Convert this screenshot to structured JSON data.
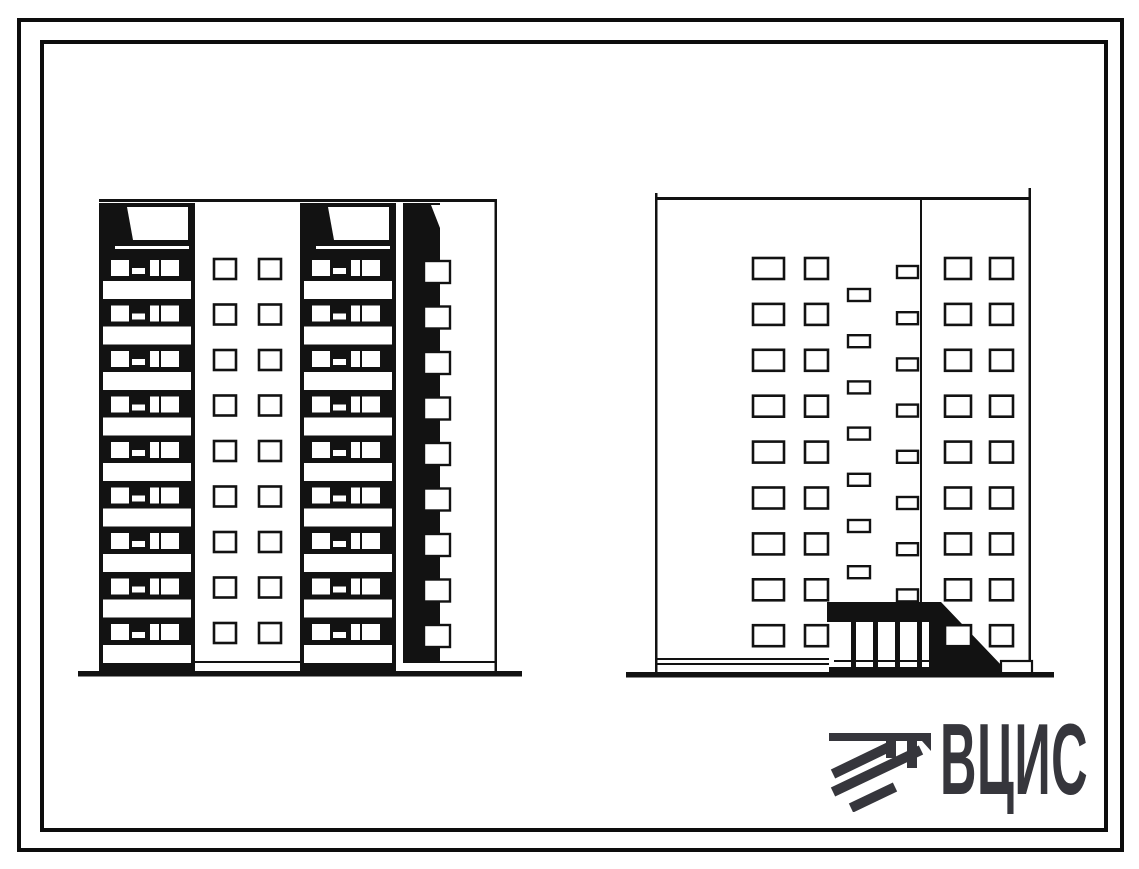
{
  "sheet": {
    "background": "#ffffff",
    "border_color": "#0d0d0d",
    "description": "Scanned architectural sheet with two elevations of a 9-storey large-panel residential block"
  },
  "logo": {
    "text": "ВЦИС",
    "color": "#36363c",
    "mark": "diagonal-hatching-emblem"
  },
  "drawing": {
    "ink": "#121212",
    "paper": "#ffffff",
    "left_elevation": {
      "label": "courtyard elevation with balcony stacks",
      "floors": 9,
      "row_start": 258,
      "row_pitch": 45.5,
      "left": 99,
      "top": 199,
      "right": 497,
      "balcony_columns": [
        99,
        300
      ],
      "balcony_width": 96,
      "window_pair_x": [
        214,
        259
      ],
      "window_size": [
        22,
        20
      ],
      "side_strip": {
        "x": 403,
        "w": 37,
        "win_x": 424,
        "win_w": 26,
        "win_h": 22,
        "win_start": 261
      },
      "plinth_y": 661,
      "ground": {
        "x1": 78,
        "x2": 522,
        "y": 671
      }
    },
    "right_elevation": {
      "label": "street elevation with entrance porch",
      "floors": 9,
      "row_start": 258,
      "row_pitch": 45.9,
      "left": 655,
      "right": 1031,
      "top": 197,
      "bottom": 672,
      "divider_x": 920,
      "divider_bottom": 602,
      "window_columns": [
        {
          "x": 753,
          "w": 31
        },
        {
          "x": 805,
          "w": 23
        },
        {
          "x": 945,
          "w": 26
        },
        {
          "x": 990,
          "w": 23
        }
      ],
      "window_h": 21,
      "stair_windows": {
        "right_col": {
          "x": 897,
          "y0": 266,
          "w": 21,
          "h": 12,
          "count": 8,
          "pitch": 46.2
        },
        "left_col": {
          "x": 848,
          "y0": 289,
          "w": 22,
          "h": 12,
          "count": 7,
          "pitch": 46.2
        }
      },
      "entrance": {
        "canopy_x1": 827,
        "canopy_x2": 941,
        "canopy_y1": 602,
        "canopy_y2": 622,
        "glass_x2": 929,
        "ramp_tip_x": 1003,
        "base_y": 667,
        "mullions": [
          851,
          873,
          895,
          917
        ],
        "platform": [
          829,
          667,
          181,
          9
        ],
        "plinth_box": [
          1001,
          661,
          31,
          13
        ]
      },
      "basement_lines": [
        658,
        663
      ],
      "basement_x2": 829,
      "ground": {
        "x1": 626,
        "x2": 1054,
        "y": 672
      }
    }
  }
}
